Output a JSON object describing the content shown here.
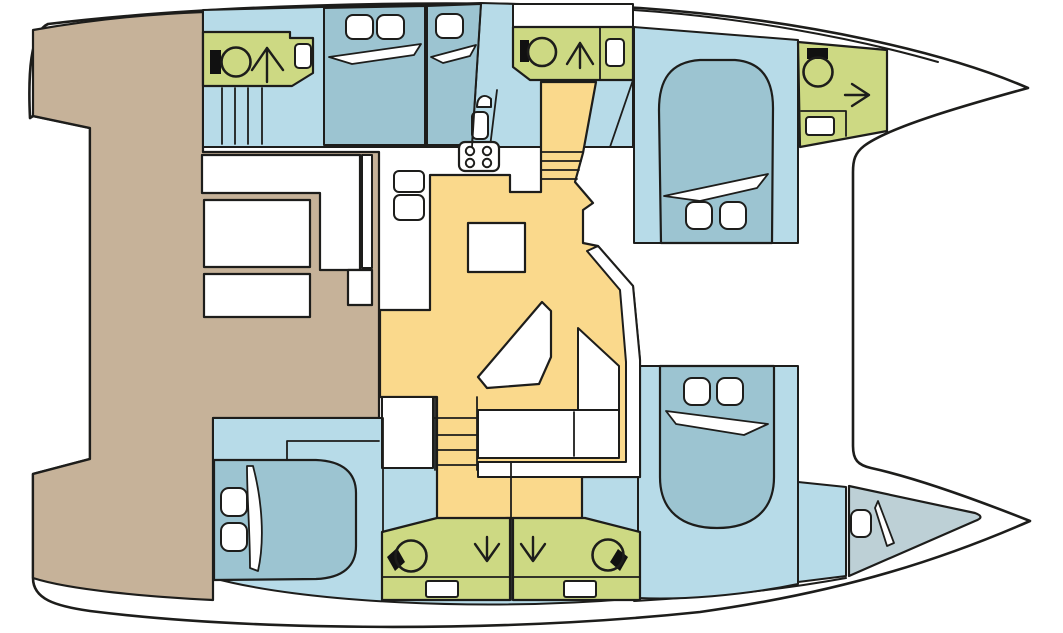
{
  "meta": {
    "kind": "catamaran-interior-floor-plan",
    "width": 1063,
    "height": 633
  },
  "palette": {
    "outline": "#1d1d1b",
    "white": "#ffffff",
    "black": "#111111",
    "deck_tan": "#c6b299",
    "floor_blue": "#b7dbe8",
    "bed_blue": "#9cc4d1",
    "forepeak_blue": "#bdd0d6",
    "bathroom_green": "#cdd983",
    "salon_yellow": "#fad98c"
  },
  "shapes": [
    {
      "name": "hull-silhouette",
      "type": "path",
      "d": "M 30,118 C 28,75 30,32 48,24 C 200,6 420,-2 640,8 C 810,20 950,54 1028,88 C 955,108 888,128 864,146 C 855,153 853,160 853,172 L 853,446 C 853,460 858,465 871,468 C 912,477 972,498 1030,521 C 950,556 850,591 700,612 C 500,633 250,631 90,611 C 55,606 33,599 33,578 L 33,474 L 90,459 L 90,128 L 33,116 Z",
      "fill": "$white",
      "stroke": "$outline",
      "sw": 2.6
    },
    {
      "name": "deck-rim-bow-top",
      "type": "path",
      "d": "M 634,10 C 740,17 855,38 938,62",
      "fill": "none",
      "stroke": "$outline",
      "sw": 2
    },
    {
      "name": "deck-rim-bow-bottom",
      "type": "path",
      "d": "M 634,601 C 720,596 780,590 846,578",
      "fill": "none",
      "stroke": "$outline",
      "sw": 2
    },
    {
      "name": "aft-deck-cockpit",
      "type": "path",
      "d": "M 33,30 C 90,20 150,14 203,12 L 203,152 L 379,152 L 379,418 L 213,418 L 213,600 C 150,597 70,590 33,578 L 33,474 L 90,459 L 90,128 L 33,116 Z",
      "fill": "$deck_tan",
      "stroke": "$outline",
      "sw": 2.2
    },
    {
      "name": "cabin-forward-top-floor",
      "type": "path",
      "d": "M 634,27 L 798,40 L 798,243 L 634,243 Z",
      "fill": "$floor_blue",
      "stroke": "$outline",
      "sw": 2
    },
    {
      "name": "hull-top-floor",
      "type": "path",
      "d": "M 203,10 L 322,7 L 425,5 L 481,3 L 516,4 L 633,7 L 633,147 L 203,147 Z",
      "fill": "$floor_blue",
      "stroke": "$outline",
      "sw": 2
    },
    {
      "name": "deck-patch-above-head",
      "type": "rect",
      "x": 513,
      "y": 4,
      "w": 120,
      "h": 23,
      "fill": "$white",
      "stroke": "$outline",
      "sw": 2
    },
    {
      "name": "hull-bottom-floor",
      "type": "path",
      "d": "M 213,418 L 477,418 L 477,462 L 640,462 L 640,598 C 480,612 300,602 213,578 Z",
      "fill": "$floor_blue",
      "stroke": "$outline",
      "sw": 2
    },
    {
      "name": "cabin-forward-bottom-floor",
      "type": "path",
      "d": "M 638,366 L 798,366 L 798,584 C 740,596 680,600 638,598 Z",
      "fill": "$floor_blue",
      "stroke": "$outline",
      "sw": 2
    },
    {
      "name": "bow-corridor-bottom",
      "type": "polygon",
      "points": "798,482 846,487 846,576 798,582",
      "fill": "$floor_blue",
      "stroke": "$outline",
      "sw": 2
    },
    {
      "name": "forepeak-berth",
      "type": "path",
      "d": "M 849,486 L 975,513 Q 986,517 975,521 L 849,576 Z",
      "fill": "$forepeak_blue",
      "stroke": "$outline",
      "sw": 2.2
    },
    {
      "name": "salon-floor",
      "type": "path",
      "d": "M 430,175 L 510,175 L 510,192 L 541,192 L 541,82 L 596,82 L 583,153 L 575,182 L 593,203 L 583,210 L 583,243 L 598,246 L 633,286 L 640,360 L 640,477 L 582,477 L 582,520 L 510,518 L 437,520 L 437,397 L 380,397 L 380,310 L 430,310 Z",
      "fill": "$salon_yellow",
      "stroke": "$outline",
      "sw": 2.2
    },
    {
      "name": "stairs-top-step-lines",
      "type": "path",
      "d": "M 541,152 L 583,152 M 541,161 L 581,161 M 541,170 L 579,170 M 541,179 L 577,179",
      "fill": "none",
      "stroke": "$outline",
      "sw": 1.8
    },
    {
      "name": "stairwell-bottom-landing",
      "type": "rect",
      "x": 382,
      "y": 397,
      "w": 51,
      "h": 71,
      "fill": "$white",
      "stroke": "$outline",
      "sw": 2
    },
    {
      "name": "stairs-bottom-step-lines",
      "type": "path",
      "d": "M 437,418 L 477,418 M 437,435 L 477,435 M 437,450 L 477,450 M 437,465 L 477,465 M 435,397 L 435,470 M 477,397 L 477,470",
      "fill": "none",
      "stroke": "$outline",
      "sw": 1.8
    },
    {
      "name": "head-aft-top",
      "type": "polygon",
      "points": "203,32 290,32 290,38 313,38 313,73 292,86 203,86",
      "fill": "$bathroom_green",
      "stroke": "$outline",
      "sw": 2.2
    },
    {
      "name": "sink-head-aft-top",
      "type": "rect",
      "x": 295,
      "y": 44,
      "w": 16,
      "h": 24,
      "rx": 4,
      "fill": "$white",
      "stroke": "$outline",
      "sw": 2
    },
    {
      "name": "toilet-tank-aft-top",
      "type": "rect",
      "x": 210,
      "y": 50,
      "w": 11,
      "h": 24,
      "fill": "$black",
      "stroke": "none",
      "sw": 0
    },
    {
      "name": "toilet-bowl-aft-top",
      "type": "circle",
      "cx": 236,
      "cy": 62,
      "r": 14.5,
      "fill": "none",
      "stroke": "$outline",
      "sw": 2.6
    },
    {
      "name": "shower-arrow-up-aft-top",
      "type": "path",
      "d": "M 267,82 L 267,48 M 267,48 L 252,70 M 267,48 L 283,70",
      "fill": "none",
      "stroke": "$outline",
      "sw": 2.4
    },
    {
      "name": "stairs-hull-top-lines",
      "type": "path",
      "d": "M 222,88 L 222,144 M 235,88 L 235,144 M 248,88 L 248,144 M 262,88 L 262,144",
      "fill": "none",
      "stroke": "$outline",
      "sw": 1.8
    },
    {
      "name": "bed-cabin-top-1",
      "type": "polygon",
      "points": "324,8 425,6 425,145 324,145",
      "fill": "$bed_blue",
      "stroke": "$outline",
      "sw": 2
    },
    {
      "name": "pillow-cabin-top-1a",
      "type": "rect",
      "x": 346,
      "y": 15,
      "w": 27,
      "h": 24,
      "rx": 7,
      "fill": "$white",
      "stroke": "$outline",
      "sw": 2
    },
    {
      "name": "pillow-cabin-top-1b",
      "type": "rect",
      "x": 377,
      "y": 15,
      "w": 27,
      "h": 24,
      "rx": 7,
      "fill": "$white",
      "stroke": "$outline",
      "sw": 2
    },
    {
      "name": "blanket-cabin-top-1",
      "type": "polygon",
      "points": "329,57 421,44 414,55 352,64",
      "fill": "$white",
      "stroke": "$outline",
      "sw": 1.8
    },
    {
      "name": "bed-cabin-top-2",
      "type": "polygon",
      "points": "427,6 481,4 472,145 427,145",
      "fill": "$bed_blue",
      "stroke": "$outline",
      "sw": 2
    },
    {
      "name": "pillow-cabin-top-2",
      "type": "rect",
      "x": 436,
      "y": 14,
      "w": 27,
      "h": 24,
      "rx": 7,
      "fill": "$white",
      "stroke": "$outline",
      "sw": 2
    },
    {
      "name": "blanket-cabin-top-2",
      "type": "polygon",
      "points": "431,57 476,45 470,56 443,63",
      "fill": "$white",
      "stroke": "$outline",
      "sw": 1.8
    },
    {
      "name": "corridor-wall-line",
      "type": "line",
      "x1": 497,
      "y1": 90,
      "x2": 490,
      "y2": 147,
      "stroke": "$outline",
      "sw": 1.8
    },
    {
      "name": "corridor-basin",
      "type": "path",
      "d": "M 477,107 C 477,96 485,93 491,99 L 491,107 Z",
      "fill": "$white",
      "stroke": "$outline",
      "sw": 2
    },
    {
      "name": "corridor-seat",
      "type": "rect",
      "x": 472,
      "y": 112,
      "w": 16,
      "h": 27,
      "rx": 5,
      "fill": "$white",
      "stroke": "$outline",
      "sw": 2
    },
    {
      "name": "head-mid-top",
      "type": "polygon",
      "points": "513,27 633,27 633,80 530,80 513,67",
      "fill": "$bathroom_green",
      "stroke": "$outline",
      "sw": 2.2
    },
    {
      "name": "head-mid-top-divider",
      "type": "line",
      "x1": 600,
      "y1": 27,
      "x2": 600,
      "y2": 80,
      "stroke": "$outline",
      "sw": 1.8
    },
    {
      "name": "sink-head-mid-top",
      "type": "rect",
      "x": 606,
      "y": 39,
      "w": 18,
      "h": 27,
      "rx": 4,
      "fill": "$white",
      "stroke": "$outline",
      "sw": 2
    },
    {
      "name": "toilet-tank-mid-top",
      "type": "rect",
      "x": 520,
      "y": 40,
      "w": 9,
      "h": 22,
      "fill": "$black",
      "stroke": "none",
      "sw": 0
    },
    {
      "name": "toilet-bowl-mid-top",
      "type": "circle",
      "cx": 542,
      "cy": 52,
      "r": 14,
      "fill": "none",
      "stroke": "$outline",
      "sw": 2.6
    },
    {
      "name": "shower-arrow-up-mid-top",
      "type": "path",
      "d": "M 580,68 L 580,43 M 580,43 L 567,64 M 580,43 L 593,64",
      "fill": "none",
      "stroke": "$outline",
      "sw": 2.4
    },
    {
      "name": "wall-wedge-stairs-top",
      "type": "line",
      "x1": 633,
      "y1": 80,
      "x2": 610,
      "y2": 147,
      "stroke": "$outline",
      "sw": 1.8
    },
    {
      "name": "galley-sink-1",
      "type": "rect",
      "x": 394,
      "y": 171,
      "w": 30,
      "h": 21,
      "rx": 5,
      "fill": "$white",
      "stroke": "$outline",
      "sw": 2
    },
    {
      "name": "galley-sink-2",
      "type": "rect",
      "x": 394,
      "y": 195,
      "w": 30,
      "h": 25,
      "rx": 6,
      "fill": "$white",
      "stroke": "$outline",
      "sw": 2
    },
    {
      "name": "stove",
      "type": "rect",
      "x": 459,
      "y": 142,
      "w": 40,
      "h": 29,
      "rx": 6,
      "fill": "$white",
      "stroke": "$outline",
      "sw": 2.2
    },
    {
      "name": "stove-burner-1",
      "type": "circle",
      "cx": 470,
      "cy": 151,
      "r": 4.2,
      "fill": "$white",
      "stroke": "$outline",
      "sw": 2
    },
    {
      "name": "stove-burner-2",
      "type": "circle",
      "cx": 487,
      "cy": 151,
      "r": 4.2,
      "fill": "$white",
      "stroke": "$outline",
      "sw": 2
    },
    {
      "name": "stove-burner-3",
      "type": "circle",
      "cx": 470,
      "cy": 163,
      "r": 4.2,
      "fill": "$white",
      "stroke": "$outline",
      "sw": 2
    },
    {
      "name": "stove-burner-4",
      "type": "circle",
      "cx": 487,
      "cy": 163,
      "r": 4.2,
      "fill": "$white",
      "stroke": "$outline",
      "sw": 2
    },
    {
      "name": "dinette-table",
      "type": "rect",
      "x": 468,
      "y": 223,
      "w": 57,
      "h": 49,
      "fill": "$white",
      "stroke": "$outline",
      "sw": 2.2
    },
    {
      "name": "lounge-seat",
      "type": "polygon",
      "points": "542,302 551,311 551,357 539,384 487,388 478,377",
      "fill": "$white",
      "stroke": "$outline",
      "sw": 2.2
    },
    {
      "name": "settee-backrest-band",
      "type": "polygon",
      "points": "598,246 633,286 640,360 640,477 478,477 478,462 626,462 626,362 620,290 587,251",
      "fill": "$white",
      "stroke": "$outline",
      "sw": 2
    },
    {
      "name": "settee-bench-right",
      "type": "polygon",
      "points": "578,328 619,366 619,410 578,410",
      "fill": "$white",
      "stroke": "$outline",
      "sw": 2
    },
    {
      "name": "settee-bench-bottom",
      "type": "rect",
      "x": 478,
      "y": 410,
      "w": 141,
      "h": 48,
      "fill": "$white",
      "stroke": "$outline",
      "sw": 2
    },
    {
      "name": "settee-seat-divider",
      "type": "line",
      "x1": 574,
      "y1": 412,
      "x2": 574,
      "y2": 456,
      "stroke": "$outline",
      "sw": 1.8
    },
    {
      "name": "cockpit-bench-L",
      "type": "path",
      "d": "M 202,155 L 360,155 L 360,270 L 320,270 L 320,193 L 202,193 Z",
      "fill": "$white",
      "stroke": "$outline",
      "sw": 2.2
    },
    {
      "name": "cockpit-bench-strip",
      "type": "rect",
      "x": 362,
      "y": 155,
      "w": 10,
      "h": 113,
      "fill": "$white",
      "stroke": "$outline",
      "sw": 2
    },
    {
      "name": "cockpit-table-a",
      "type": "rect",
      "x": 204,
      "y": 200,
      "w": 106,
      "h": 67,
      "fill": "$white",
      "stroke": "$outline",
      "sw": 2.2
    },
    {
      "name": "cockpit-table-b",
      "type": "rect",
      "x": 204,
      "y": 274,
      "w": 106,
      "h": 43,
      "fill": "$white",
      "stroke": "$outline",
      "sw": 2.2
    },
    {
      "name": "cockpit-small-box",
      "type": "rect",
      "x": 348,
      "y": 270,
      "w": 24,
      "h": 35,
      "fill": "$white",
      "stroke": "$outline",
      "sw": 2.2
    },
    {
      "name": "head-bottom-left",
      "type": "polygon",
      "points": "382,532 437,518 510,518 510,600 382,600",
      "fill": "$bathroom_green",
      "stroke": "$outline",
      "sw": 2.2
    },
    {
      "name": "head-bottom-left-counter-line",
      "type": "line",
      "x1": 382,
      "y1": 577,
      "x2": 510,
      "y2": 577,
      "stroke": "$outline",
      "sw": 1.8
    },
    {
      "name": "sink-head-bottom-left",
      "type": "rect",
      "x": 426,
      "y": 581,
      "w": 32,
      "h": 16,
      "rx": 2,
      "fill": "$white",
      "stroke": "$outline",
      "sw": 2
    },
    {
      "name": "toilet-tank-bottom-left",
      "type": "polygon",
      "points": "387,557 397,548 405,562 395,571",
      "fill": "$black",
      "stroke": "none",
      "sw": 0
    },
    {
      "name": "toilet-bowl-bottom-left",
      "type": "circle",
      "cx": 411,
      "cy": 556,
      "r": 15.5,
      "fill": "none",
      "stroke": "$outline",
      "sw": 2.6
    },
    {
      "name": "shower-arrow-down-left",
      "type": "path",
      "d": "M 487,537 L 487,561 M 487,561 L 475,544 M 487,561 L 499,544",
      "fill": "none",
      "stroke": "$outline",
      "sw": 2.4
    },
    {
      "name": "head-bottom-right",
      "type": "polygon",
      "points": "513,518 585,518 640,532 640,600 513,600",
      "fill": "$bathroom_green",
      "stroke": "$outline",
      "sw": 2.2
    },
    {
      "name": "head-bottom-right-counter-line",
      "type": "line",
      "x1": 513,
      "y1": 577,
      "x2": 640,
      "y2": 577,
      "stroke": "$outline",
      "sw": 1.8
    },
    {
      "name": "sink-head-bottom-right",
      "type": "rect",
      "x": 564,
      "y": 581,
      "w": 32,
      "h": 16,
      "rx": 2,
      "fill": "$white",
      "stroke": "$outline",
      "sw": 2
    },
    {
      "name": "toilet-tank-bottom-right",
      "type": "polygon",
      "points": "618,549 628,557 620,571 610,562",
      "fill": "$black",
      "stroke": "none",
      "sw": 0
    },
    {
      "name": "toilet-bowl-bottom-right",
      "type": "circle",
      "cx": 608,
      "cy": 555,
      "r": 15.5,
      "fill": "none",
      "stroke": "$outline",
      "sw": 2.6
    },
    {
      "name": "shower-arrow-down-right",
      "type": "path",
      "d": "M 533,537 L 533,561 M 533,561 L 521,544 M 533,561 L 545,544",
      "fill": "none",
      "stroke": "$outline",
      "sw": 2.4
    },
    {
      "name": "heads-bottom-center-wall",
      "type": "line",
      "x1": 511,
      "y1": 463,
      "x2": 511,
      "y2": 600,
      "stroke": "$outline",
      "sw": 1.8
    },
    {
      "name": "cabin-aft-bottom-wall",
      "type": "line",
      "x1": 383,
      "y1": 418,
      "x2": 383,
      "y2": 532,
      "stroke": "$outline",
      "sw": 1.8
    },
    {
      "name": "bed-aft-bottom",
      "type": "path",
      "d": "M 214,460 L 316,460 C 343,461 356,473 356,493 L 356,546 C 356,566 343,578 316,579 L 214,580 Z",
      "fill": "$bed_blue",
      "stroke": "$outline",
      "sw": 2.2
    },
    {
      "name": "pillow-aft-bottom-a",
      "type": "rect",
      "x": 221,
      "y": 488,
      "w": 26,
      "h": 28,
      "rx": 8,
      "fill": "$white",
      "stroke": "$outline",
      "sw": 2
    },
    {
      "name": "pillow-aft-bottom-b",
      "type": "rect",
      "x": 221,
      "y": 523,
      "w": 26,
      "h": 28,
      "rx": 8,
      "fill": "$white",
      "stroke": "$outline",
      "sw": 2
    },
    {
      "name": "blanket-aft-bottom",
      "type": "path",
      "d": "M 253,466 C 262,500 265,540 258,571 L 250,568 C 250,532 247,498 247,466 Z",
      "fill": "$white",
      "stroke": "$outline",
      "sw": 1.8
    },
    {
      "name": "shelf-lines-aft-bottom",
      "type": "path",
      "d": "M 287,441 L 379,441 M 287,441 L 287,460",
      "fill": "none",
      "stroke": "$outline",
      "sw": 1.8
    },
    {
      "name": "bed-forward-top",
      "type": "path",
      "d": "M 661,243 L 659,110 C 659,80 670,62 700,60 L 735,60 C 762,62 773,80 773,108 L 772,243 Z",
      "fill": "$bed_blue",
      "stroke": "$outline",
      "sw": 2.2
    },
    {
      "name": "blanket-forward-top",
      "type": "polygon",
      "points": "664,196 768,174 757,188 700,201",
      "fill": "$white",
      "stroke": "$outline",
      "sw": 1.8
    },
    {
      "name": "pillow-forward-top-a",
      "type": "rect",
      "x": 686,
      "y": 202,
      "w": 26,
      "h": 27,
      "rx": 8,
      "fill": "$white",
      "stroke": "$outline",
      "sw": 2
    },
    {
      "name": "pillow-forward-top-b",
      "type": "rect",
      "x": 720,
      "y": 202,
      "w": 26,
      "h": 27,
      "rx": 8,
      "fill": "$white",
      "stroke": "$outline",
      "sw": 2
    },
    {
      "name": "bed-forward-bottom",
      "type": "path",
      "d": "M 660,366 L 774,366 L 774,477 C 774,511 752,528 717,528 C 682,528 660,511 660,477 Z",
      "fill": "$bed_blue",
      "stroke": "$outline",
      "sw": 2.2
    },
    {
      "name": "pillow-forward-bottom-a",
      "type": "rect",
      "x": 684,
      "y": 378,
      "w": 26,
      "h": 27,
      "rx": 8,
      "fill": "$white",
      "stroke": "$outline",
      "sw": 2
    },
    {
      "name": "pillow-forward-bottom-b",
      "type": "rect",
      "x": 717,
      "y": 378,
      "w": 26,
      "h": 27,
      "rx": 8,
      "fill": "$white",
      "stroke": "$outline",
      "sw": 2
    },
    {
      "name": "blanket-forward-bottom",
      "type": "polygon",
      "points": "666,411 768,424 744,435 676,424",
      "fill": "$white",
      "stroke": "$outline",
      "sw": 1.8
    },
    {
      "name": "pillow-forepeak",
      "type": "rect",
      "x": 851,
      "y": 510,
      "w": 20,
      "h": 27,
      "rx": 7,
      "fill": "$white",
      "stroke": "$outline",
      "sw": 2
    },
    {
      "name": "blanket-forepeak",
      "type": "polygon",
      "points": "878,501 894,543 887,546 875,508",
      "fill": "$white",
      "stroke": "$outline",
      "sw": 1.8
    },
    {
      "name": "head-bow-top",
      "type": "polygon",
      "points": "798,42 887,50 887,131 800,147",
      "fill": "$bathroom_green",
      "stroke": "$outline",
      "sw": 2.2
    },
    {
      "name": "toilet-tank-bow-top",
      "type": "rect",
      "x": 807,
      "y": 48,
      "w": 21,
      "h": 11,
      "fill": "$black",
      "stroke": "none",
      "sw": 0
    },
    {
      "name": "toilet-bowl-bow-top",
      "type": "circle",
      "cx": 818,
      "cy": 72,
      "r": 14.5,
      "fill": "none",
      "stroke": "$outline",
      "sw": 2.6
    },
    {
      "name": "shower-arrow-right-bow",
      "type": "path",
      "d": "M 845,95 L 869,95 M 869,95 L 852,84 M 869,95 L 852,106",
      "fill": "none",
      "stroke": "$outline",
      "sw": 2.4
    },
    {
      "name": "counter-lines-bow-top",
      "type": "path",
      "d": "M 801,111 L 846,111 M 846,111 L 846,136",
      "fill": "none",
      "stroke": "$outline",
      "sw": 1.8
    },
    {
      "name": "sink-bow-top",
      "type": "rect",
      "x": 806,
      "y": 117,
      "w": 28,
      "h": 18,
      "rx": 3,
      "fill": "$white",
      "stroke": "$outline",
      "sw": 2
    },
    {
      "name": "mast-support-line",
      "type": "line",
      "x1": 481,
      "y1": 4,
      "x2": 472,
      "y2": 147,
      "stroke": "$outline",
      "sw": 1.8
    },
    {
      "name": "cabin-divider-top",
      "type": "line",
      "x1": 426,
      "y1": 5,
      "x2": 426,
      "y2": 146,
      "stroke": "$outline",
      "sw": 1.8
    }
  ]
}
